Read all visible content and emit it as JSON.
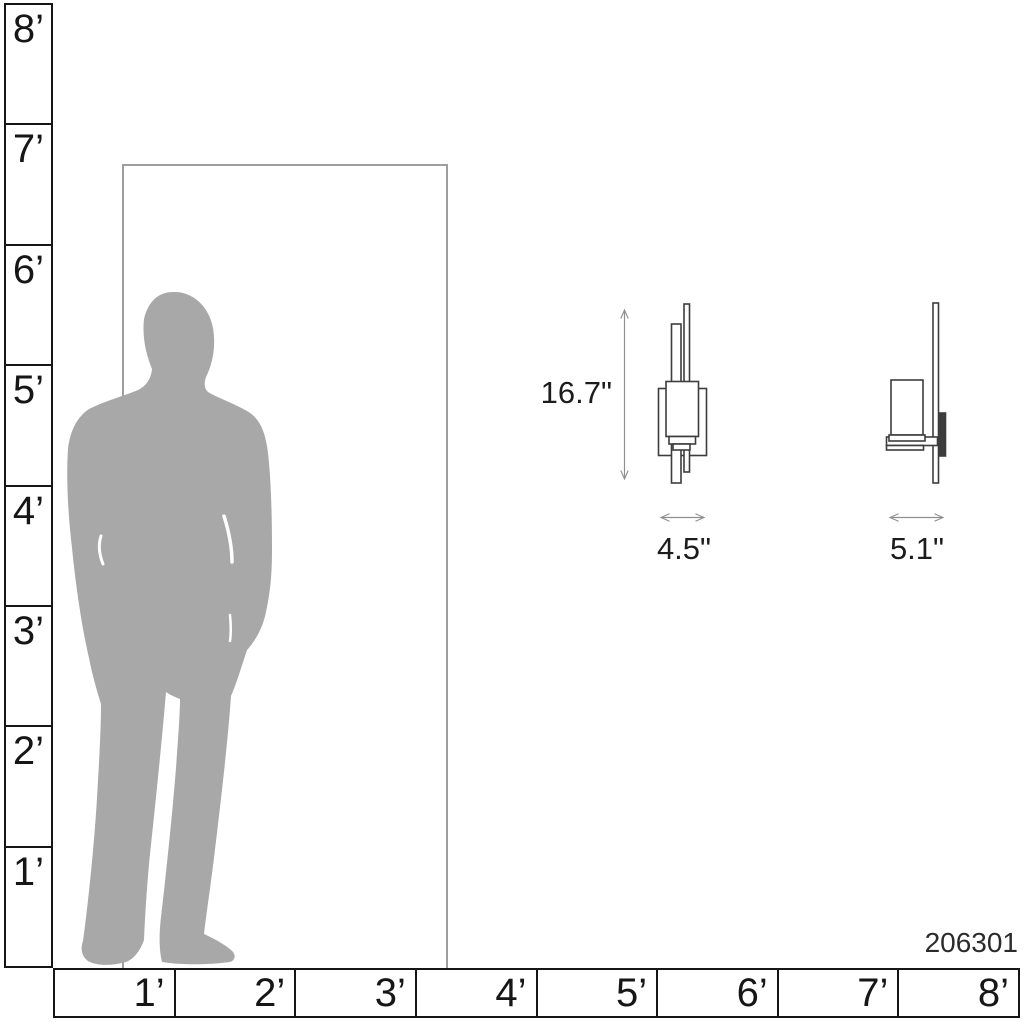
{
  "diagram": {
    "description": "Scale diagram of wall sconce with human figure and door for reference",
    "product_number": "206301"
  },
  "rulers": {
    "vertical_labels": [
      "8’",
      "7’",
      "6’",
      "5’",
      "4’",
      "3’",
      "2’",
      "1’"
    ],
    "horizontal_labels": [
      "1’",
      "2’",
      "3’",
      "4’",
      "5’",
      "6’",
      "7’",
      "8’"
    ]
  },
  "dimensions": {
    "height": "16.7\"",
    "width": "4.5\"",
    "depth": "5.1\""
  },
  "colors": {
    "silhouette_gray": "#a8a8a8",
    "door_border": "#9e9e9e",
    "ruler_border": "#161616",
    "drawing_line": "#3d3d3d",
    "dimension_line": "#8f8f8f",
    "text": "#1c1c1c"
  }
}
